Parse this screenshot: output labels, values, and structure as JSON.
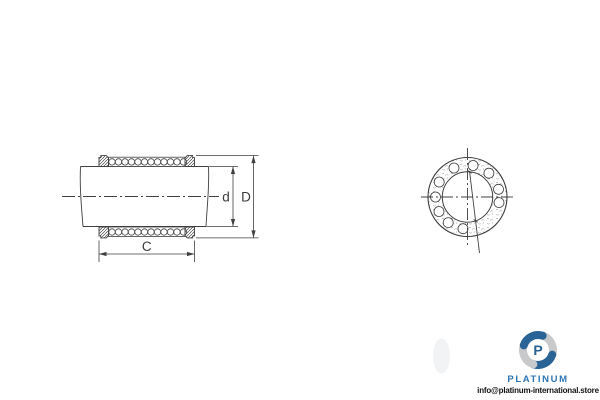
{
  "diagram": {
    "line_color": "#3f3f3f",
    "labels": {
      "C": "C",
      "d": "d",
      "D": "D"
    }
  },
  "branding": {
    "logo_initial": "P",
    "name": "PLATINUM",
    "email": "info@platinum-international.store",
    "logo_blue": "#2a6496",
    "logo_gray": "#c7c9cb",
    "name_color": "#2e75b6"
  }
}
